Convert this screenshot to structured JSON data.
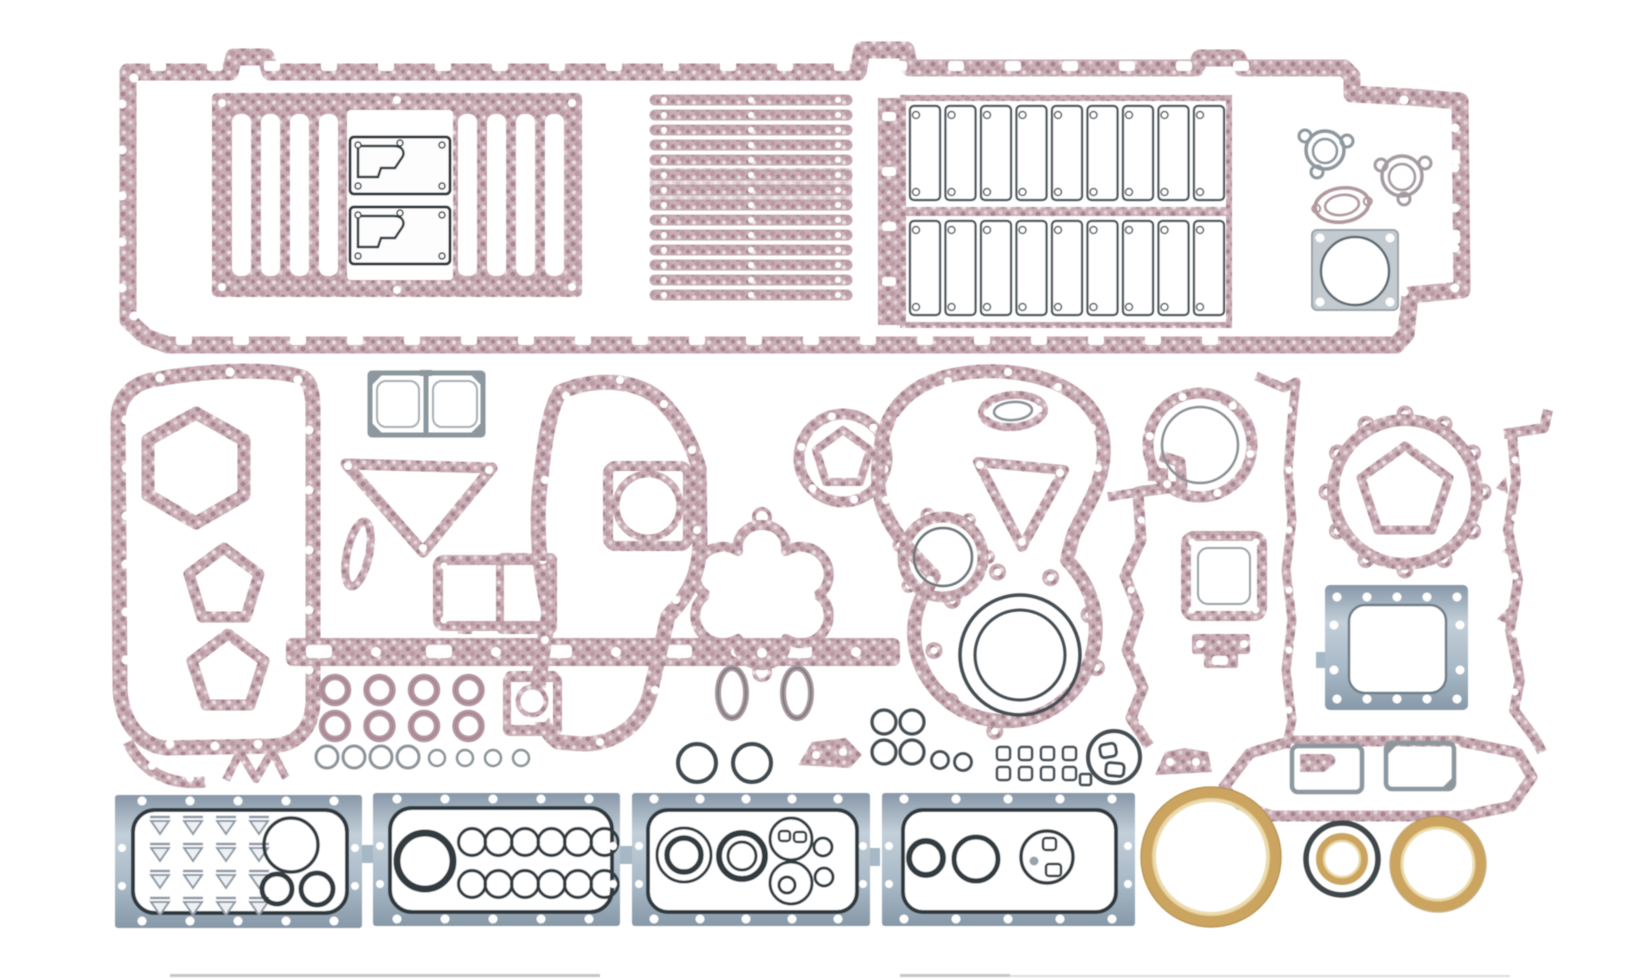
{
  "meta": {
    "description": "Product photograph of a complete diesel engine overhaul gasket kit laid out on a white background: long pan-rail block gasket with ladder and slat gaskets, push-rod cover strips, timing and front-cover gaskets in pink fiber, four blue-steel cover plates with rubber seal outlines, and gold crankshaft seal rings.",
    "width": 1648,
    "height": 979
  },
  "palette": {
    "bg": "#ffffff",
    "pink_base": "#c9aeb5",
    "pink_mid": "#bb9aa4",
    "pink_dark": "#a8858f",
    "pink_pale": "#e3d3d7",
    "outline_dark": "#353e44",
    "outline_gray": "#8d979e",
    "plate_blue": "#a6b7c5",
    "plate_blue_dark": "#8798a8",
    "plate_blue_light": "#c3cfd9",
    "gold": "#cba561",
    "gold_light": "#ead8a6"
  },
  "parts": [
    {
      "name": "pan-rail-frame-gasket",
      "material": "pink-fiber"
    },
    {
      "name": "ladder-gasket",
      "material": "pink-fiber"
    },
    {
      "name": "cover-plate-gaskets-dark",
      "count": 2
    },
    {
      "name": "slat-gasket-stack",
      "count": 14
    },
    {
      "name": "push-rod-cover-cells",
      "count": 18
    },
    {
      "name": "trefoil-flange-gaskets",
      "count": 2
    },
    {
      "name": "oval-flange-gasket",
      "count": 1
    },
    {
      "name": "square-throttle-plate-gasket",
      "count": 1
    },
    {
      "name": "timing-cover-gasket-left",
      "material": "pink-fiber"
    },
    {
      "name": "double-square-steel-gasket",
      "count": 1
    },
    {
      "name": "v-brace-gasket",
      "count": 1
    },
    {
      "name": "center-front-cover-gasket",
      "material": "pink-fiber"
    },
    {
      "name": "clover-gasket",
      "count": 1
    },
    {
      "name": "water-pump-ring-gasket",
      "count": 1
    },
    {
      "name": "bell-timing-case-gasket",
      "material": "pink-fiber"
    },
    {
      "name": "crank-seal-rings-concentric",
      "count": 2
    },
    {
      "name": "scalloped-ring-gasket-small",
      "count": 1
    },
    {
      "name": "scalloped-ring-gasket-large",
      "count": 1
    },
    {
      "name": "blue-access-plate",
      "count": 1
    },
    {
      "name": "vertical-strip-gaskets",
      "count": 2
    },
    {
      "name": "long-hexagon-frame-gasket",
      "count": 1
    },
    {
      "name": "seal-plate-panels-blue",
      "count": 4
    },
    {
      "name": "gold-crank-seal-large",
      "count": 1
    },
    {
      "name": "black-gold-seal-mid",
      "count": 1
    },
    {
      "name": "gold-seal-right",
      "count": 1
    },
    {
      "name": "grommet-rings-pink",
      "count": 8
    },
    {
      "name": "o-ring-row-small",
      "count": 8
    }
  ],
  "repeats": [
    {
      "name": "frame-slot-top",
      "parent": "top-frame-holes",
      "tag": "rect",
      "x0": 150,
      "y0": 61,
      "dx": 57,
      "perRow": 20,
      "count": 20,
      "attrs": {
        "width": 16,
        "height": 10,
        "rx": 3,
        "fill": "#ffffff"
      }
    },
    {
      "name": "frame-slot-bottom",
      "parent": "top-frame-holes",
      "tag": "rect",
      "x0": 176,
      "y0": 335,
      "dx": 57,
      "perRow": 19,
      "count": 19,
      "attrs": {
        "width": 16,
        "height": 10,
        "rx": 3,
        "fill": "#ffffff"
      }
    },
    {
      "name": "frame-hole-left",
      "parent": "top-frame-holes",
      "tag": "circle",
      "x0": 122,
      "y0": 104,
      "dy": 46,
      "perRow": 1,
      "count": 5,
      "attrs": {
        "r": 4.5,
        "fill": "#ffffff"
      }
    },
    {
      "name": "frame-hole-right",
      "parent": "top-frame-holes",
      "tag": "circle",
      "x0": 1455,
      "y0": 128,
      "dy": 40,
      "perRow": 1,
      "count": 5,
      "attrs": {
        "r": 4.5,
        "fill": "#ffffff"
      }
    },
    {
      "name": "ladder-slot",
      "parent": "ladder-slots",
      "tag": "rect",
      "x0": 232,
      "y0": 114,
      "dx": 29,
      "perRow": 4,
      "count": 4,
      "attrs": {
        "width": 19,
        "height": 162,
        "rx": 8,
        "fill": "#ffffff"
      }
    },
    {
      "name": "ladder-slot",
      "parent": "ladder-slots",
      "tag": "rect",
      "x0": 458,
      "y0": 114,
      "dx": 29,
      "perRow": 4,
      "count": 4,
      "attrs": {
        "width": 19,
        "height": 162,
        "rx": 8,
        "fill": "#ffffff"
      }
    },
    {
      "name": "slat",
      "parent": "slat-stack",
      "tag": "rect",
      "x0": 650,
      "y0": 95,
      "dy": 15,
      "perRow": 1,
      "count": 14,
      "attrs": {
        "width": 202,
        "height": 10,
        "rx": 5,
        "fill": "url(#pkA)",
        "stroke": "#b8a0a8",
        "stroke-width": 0.8
      }
    },
    {
      "name": "slat-hole",
      "parent": "slat-stack",
      "tag": "circle",
      "x0": 664,
      "y0": 100,
      "dx": 87,
      "perRow": 3,
      "dy": 15,
      "count": 42,
      "attrs": {
        "r": 3,
        "fill": "#ffffff"
      }
    },
    {
      "name": "pushrod-cell",
      "parent": "pushrod-cells",
      "tag": "rect",
      "x0": 910,
      "y0": 106,
      "dx": 35.5,
      "perRow": 9,
      "count": 9,
      "attrs": {
        "width": 30,
        "height": 94,
        "rx": 4,
        "fill": "#ffffff",
        "stroke": "#4a5358",
        "stroke-width": 2.2
      }
    },
    {
      "name": "pushrod-cell",
      "parent": "pushrod-cells",
      "tag": "rect",
      "x0": 910,
      "y0": 221,
      "dx": 35.5,
      "perRow": 9,
      "count": 9,
      "attrs": {
        "width": 30,
        "height": 94,
        "rx": 4,
        "fill": "#ffffff",
        "stroke": "#4a5358",
        "stroke-width": 2.2
      }
    },
    {
      "name": "cell-notch",
      "parent": "pushrod-cells",
      "tag": "circle",
      "x0": 916,
      "y0": 115,
      "dx": 35.5,
      "perRow": 9,
      "count": 9,
      "attrs": {
        "r": 3.5,
        "fill": "#ffffff",
        "stroke": "#4a5358",
        "stroke-width": 1.5
      }
    },
    {
      "name": "cell-notch",
      "parent": "pushrod-cells",
      "tag": "circle",
      "x0": 916,
      "y0": 192,
      "dx": 35.5,
      "perRow": 9,
      "count": 9,
      "attrs": {
        "r": 3.5,
        "fill": "#ffffff",
        "stroke": "#4a5358",
        "stroke-width": 1.5
      }
    },
    {
      "name": "cell-notch",
      "parent": "pushrod-cells",
      "tag": "circle",
      "x0": 916,
      "y0": 230,
      "dx": 35.5,
      "perRow": 9,
      "count": 9,
      "attrs": {
        "r": 3.5,
        "fill": "#ffffff",
        "stroke": "#4a5358",
        "stroke-width": 1.5
      }
    },
    {
      "name": "cell-notch",
      "parent": "pushrod-cells",
      "tag": "circle",
      "x0": 916,
      "y0": 307,
      "dx": 35.5,
      "perRow": 9,
      "count": 9,
      "attrs": {
        "r": 3.5,
        "fill": "#ffffff",
        "stroke": "#4a5358",
        "stroke-width": 1.5
      }
    },
    {
      "name": "mid-left-hole",
      "parent": "mid-left-holes",
      "tag": "circle",
      "x0": 126,
      "y0": 420,
      "dy": 48,
      "perRow": 1,
      "count": 6,
      "attrs": {
        "r": 4.5,
        "fill": "#ffffff"
      }
    },
    {
      "name": "mid-left-hole",
      "parent": "mid-left-holes",
      "tag": "circle",
      "x0": 309,
      "y0": 430,
      "dy": 60,
      "perRow": 1,
      "count": 5,
      "attrs": {
        "r": 4.5,
        "fill": "#ffffff"
      }
    },
    {
      "name": "grommet",
      "parent": "grommets",
      "tag": "use",
      "href": "#grom",
      "x0": 335,
      "y0": 690,
      "dx": 44.5,
      "perRow": 4,
      "dy": 36,
      "count": 8,
      "attrs": {}
    },
    {
      "name": "o-ring",
      "parent": "oring-row",
      "tag": "circle",
      "x0": 327,
      "y0": 757,
      "dx": 27,
      "perRow": 4,
      "count": 4,
      "attrs": {
        "r": 11,
        "fill": "none",
        "stroke": "#8c949a",
        "stroke-width": 3
      }
    },
    {
      "name": "o-ring",
      "parent": "oring-row",
      "tag": "circle",
      "x0": 437,
      "y0": 758,
      "dx": 28,
      "perRow": 4,
      "count": 4,
      "attrs": {
        "r": 8,
        "fill": "none",
        "stroke": "#8c949a",
        "stroke-width": 2.5
      }
    },
    {
      "name": "seal-ring-small",
      "parent": "ring-cluster",
      "tag": "use",
      "href": "#ringR",
      "x0": 884,
      "y0": 722,
      "dx": 28,
      "perRow": 2,
      "dy": 30,
      "count": 4,
      "attrs": {}
    },
    {
      "name": "square-seal",
      "parent": "square-grid",
      "tag": "rect",
      "x0": 997,
      "y0": 747,
      "dx": 22,
      "perRow": 4,
      "dy": 20,
      "count": 8,
      "attrs": {
        "width": 13,
        "height": 13,
        "rx": 3,
        "fill": "#ffffff",
        "stroke": "#454e52",
        "stroke-width": 2.5
      }
    },
    {
      "name": "wp-hole",
      "parent": "waterpump-holes",
      "tag": "circle",
      "polar": {
        "cx": 843,
        "cy": 458,
        "r": 43,
        "a0": 15,
        "da": 60
      },
      "count": 6,
      "attrs": {
        "r": 4,
        "fill": "#ffffff"
      }
    },
    {
      "name": "bell-ear",
      "parent": "bell-ears",
      "tag": "use",
      "href": "#earBig",
      "polar": {
        "cx": 1016,
        "cy": 652,
        "r": 82,
        "a0": 105,
        "da": 38
      },
      "count": 8,
      "attrs": {}
    },
    {
      "name": "p-ear",
      "parent": "ringP-ears",
      "tag": "use",
      "href": "#earSmall",
      "polar": {
        "cx": 943,
        "cy": 557,
        "r": 45,
        "a0": 140,
        "da": 55
      },
      "count": 5,
      "attrs": {}
    },
    {
      "name": "v-hole",
      "parent": "ringV-holes",
      "tag": "circle",
      "polar": {
        "cx": 1200,
        "cy": 445,
        "r": 51,
        "a0": 10,
        "da": 60
      },
      "count": 6,
      "attrs": {
        "r": 4,
        "fill": "#ffffff"
      }
    },
    {
      "name": "z-ear",
      "parent": "ringZ-ears",
      "tag": "use",
      "href": "#earBig",
      "polar": {
        "cx": 1405,
        "cy": 492,
        "r": 78,
        "a0": 0,
        "da": 30
      },
      "count": 12,
      "attrs": {}
    },
    {
      "name": "z-pent-hole",
      "parent": "ringZ-ears",
      "tag": "circle",
      "polar": {
        "cx": 1405,
        "cy": 490,
        "r": 46,
        "a0": -90,
        "da": 72
      },
      "count": 5,
      "attrs": {
        "r": 3.5,
        "fill": "#ffffff"
      }
    },
    {
      "name": "strip-hole",
      "parent": "strip-left-holes",
      "tag": "circle",
      "x0": 1289,
      "y0": 410,
      "dy": 60,
      "perRow": 1,
      "count": 6,
      "attrs": {
        "r": 3.5,
        "fill": "#ffffff"
      }
    },
    {
      "name": "strip-hole",
      "parent": "strip-right-holes",
      "tag": "circle",
      "x0": 1515,
      "y0": 460,
      "dy": 58,
      "perRow": 1,
      "count": 5,
      "attrs": {
        "r": 3.5,
        "fill": "#ffffff"
      }
    },
    {
      "name": "hex-hole",
      "parent": "hexY-holes",
      "tag": "circle",
      "x0": 1298,
      "y0": 805,
      "dx": 58,
      "perRow": 4,
      "count": 4,
      "attrs": {
        "r": 4.5,
        "fill": "#ffffff"
      }
    },
    {
      "name": "triangle-seal",
      "parent": "p1-triangles",
      "tag": "use",
      "href": "#tri",
      "x0": 150,
      "y0": 814,
      "dx": 33,
      "perRow": 4,
      "dy": 27,
      "count": 16,
      "attrs": {}
    },
    {
      "name": "ring-seal",
      "parent": "p2-rings",
      "tag": "use",
      "href": "#ring13",
      "x0": 472,
      "y0": 842,
      "dx": 26.5,
      "perRow": 6,
      "dy": 42,
      "count": 12,
      "attrs": {}
    },
    {
      "name": "bolt-hole",
      "parent": "p1-holes",
      "tag": "circle",
      "x0": 142,
      "y0": 801,
      "dx": 48,
      "perRow": 5,
      "count": 5,
      "attrs": {
        "r": 4.5,
        "fill": "#ffffff"
      }
    },
    {
      "name": "bolt-hole",
      "parent": "p1-holes",
      "tag": "circle",
      "x0": 142,
      "y0": 921,
      "dx": 48,
      "perRow": 5,
      "count": 5,
      "attrs": {
        "r": 4.5,
        "fill": "#ffffff"
      }
    },
    {
      "name": "bolt-hole",
      "parent": "p1-holes",
      "tag": "circle",
      "x0": 122,
      "y0": 848,
      "dx": 233,
      "perRow": 2,
      "dy": 38,
      "count": 4,
      "attrs": {
        "r": 4,
        "fill": "#ffffff"
      }
    },
    {
      "name": "bolt-hole",
      "parent": "p2-holes",
      "tag": "circle",
      "x0": 397,
      "y0": 799,
      "dx": 48,
      "perRow": 5,
      "count": 5,
      "attrs": {
        "r": 4.5,
        "fill": "#ffffff"
      }
    },
    {
      "name": "bolt-hole",
      "parent": "p2-holes",
      "tag": "circle",
      "x0": 397,
      "y0": 919,
      "dx": 48,
      "perRow": 5,
      "count": 5,
      "attrs": {
        "r": 4.5,
        "fill": "#ffffff"
      }
    },
    {
      "name": "bolt-hole",
      "parent": "p2-holes",
      "tag": "circle",
      "x0": 380,
      "y0": 846,
      "dx": 233,
      "perRow": 2,
      "dy": 38,
      "count": 4,
      "attrs": {
        "r": 4,
        "fill": "#ffffff"
      }
    },
    {
      "name": "bolt-hole",
      "parent": "p3-holes",
      "tag": "circle",
      "x0": 654,
      "y0": 799,
      "dx": 46,
      "perRow": 5,
      "count": 5,
      "attrs": {
        "r": 4.5,
        "fill": "#ffffff"
      }
    },
    {
      "name": "bolt-hole",
      "parent": "p3-holes",
      "tag": "circle",
      "x0": 654,
      "y0": 919,
      "dx": 46,
      "perRow": 5,
      "count": 5,
      "attrs": {
        "r": 4.5,
        "fill": "#ffffff"
      }
    },
    {
      "name": "bolt-hole",
      "parent": "p3-holes",
      "tag": "circle",
      "x0": 639,
      "y0": 846,
      "dx": 224,
      "perRow": 2,
      "dy": 38,
      "count": 4,
      "attrs": {
        "r": 4,
        "fill": "#ffffff"
      }
    },
    {
      "name": "bolt-hole",
      "parent": "p4-holes",
      "tag": "circle",
      "x0": 904,
      "y0": 799,
      "dx": 52,
      "perRow": 5,
      "count": 5,
      "attrs": {
        "r": 4.5,
        "fill": "#ffffff"
      }
    },
    {
      "name": "bolt-hole",
      "parent": "p4-holes",
      "tag": "circle",
      "x0": 904,
      "y0": 919,
      "dx": 52,
      "perRow": 5,
      "count": 5,
      "attrs": {
        "r": 4.5,
        "fill": "#ffffff"
      }
    },
    {
      "name": "bolt-hole",
      "parent": "p4-holes",
      "tag": "circle",
      "x0": 889,
      "y0": 846,
      "dx": 239,
      "perRow": 2,
      "dy": 38,
      "count": 4,
      "attrs": {
        "r": 4,
        "fill": "#ffffff"
      }
    },
    {
      "name": "plate-hole",
      "parent": "aa-holes",
      "tag": "circle",
      "x0": 1337,
      "y0": 597,
      "dx": 30,
      "perRow": 5,
      "count": 5,
      "attrs": {
        "r": 4.5,
        "fill": "#ffffff"
      }
    },
    {
      "name": "plate-hole",
      "parent": "aa-holes",
      "tag": "circle",
      "x0": 1337,
      "y0": 699,
      "dx": 30,
      "perRow": 5,
      "count": 5,
      "attrs": {
        "r": 4.5,
        "fill": "#ffffff"
      }
    },
    {
      "name": "plate-hole",
      "parent": "aa-holes",
      "tag": "circle",
      "x0": 1334,
      "y0": 625,
      "dx": 126,
      "perRow": 2,
      "dy": 45,
      "count": 4,
      "attrs": {
        "r": 4.5,
        "fill": "#ffffff"
      }
    }
  ]
}
